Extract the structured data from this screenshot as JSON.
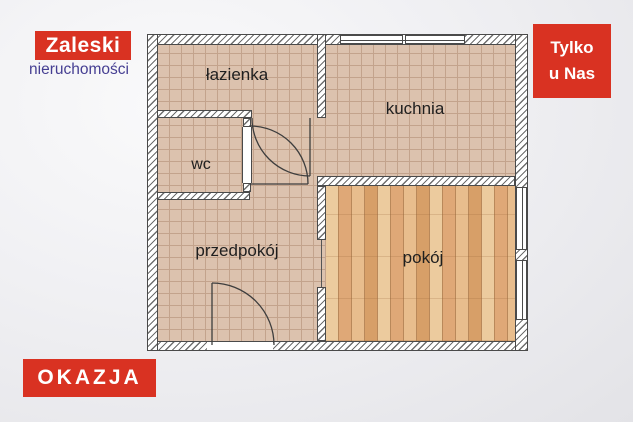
{
  "logo": {
    "title": "Zaleski",
    "subtitle": "nieruchomości"
  },
  "badges": {
    "top_right_line1": "Tylko",
    "top_right_line2": "u Nas",
    "bottom_left": "OKAZJA"
  },
  "floorplan": {
    "rooms": [
      {
        "id": "lazienka",
        "label": "łazienka",
        "floor": "tile"
      },
      {
        "id": "wc",
        "label": "wc",
        "floor": "tile"
      },
      {
        "id": "kuchnia",
        "label": "kuchnia",
        "floor": "tile"
      },
      {
        "id": "przedpokoj",
        "label": "przedpokój",
        "floor": "tile"
      },
      {
        "id": "pokoj",
        "label": "pokój",
        "floor": "wood"
      }
    ],
    "doors": [
      "lazienka-door",
      "wc-door",
      "entrance-door"
    ],
    "windows": [
      "kuchnia-top-window",
      "pokoj-window-upper",
      "pokoj-window-lower"
    ]
  },
  "colors": {
    "accent_red": "#d93222",
    "logo_purple": "#453e92",
    "wall_line": "#4a4a4a",
    "wall_hatch": "#6e6e6e",
    "tile_base": "#dcc2ae",
    "tile_grid": "#c3a38c",
    "text_dark": "#1f1f1f"
  }
}
